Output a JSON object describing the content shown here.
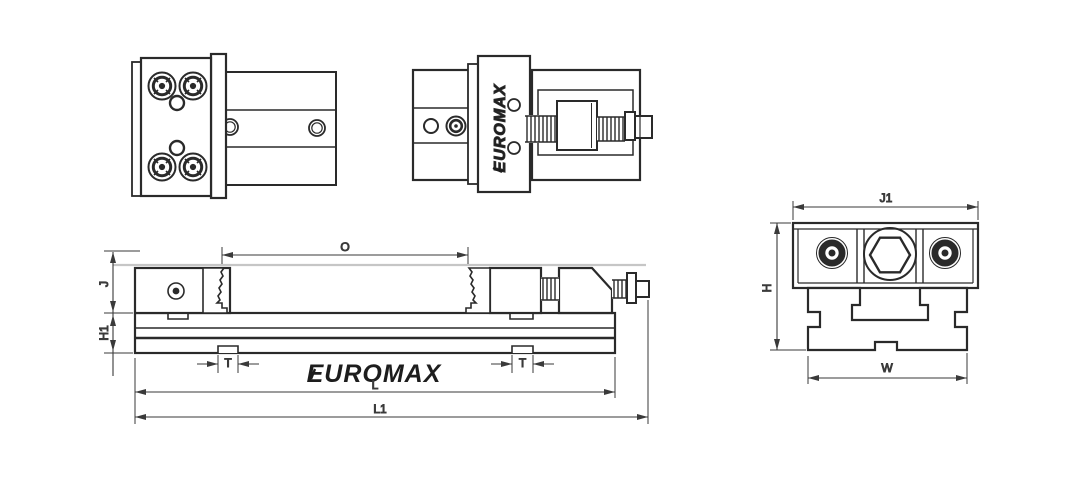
{
  "drawing": {
    "brand": "EUROMAX",
    "labels": {
      "opening": "O",
      "jaw_height": "J",
      "base_height": "H1",
      "slot_width": "T",
      "body_length": "L",
      "overall_length": "L1",
      "top_width": "J1",
      "overall_height": "H",
      "base_width": "W"
    },
    "colors": {
      "line": "#2a2a2a",
      "dim_line": "#3a3a3a",
      "highlight": "#c6c6c6",
      "background": "#ffffff"
    }
  }
}
